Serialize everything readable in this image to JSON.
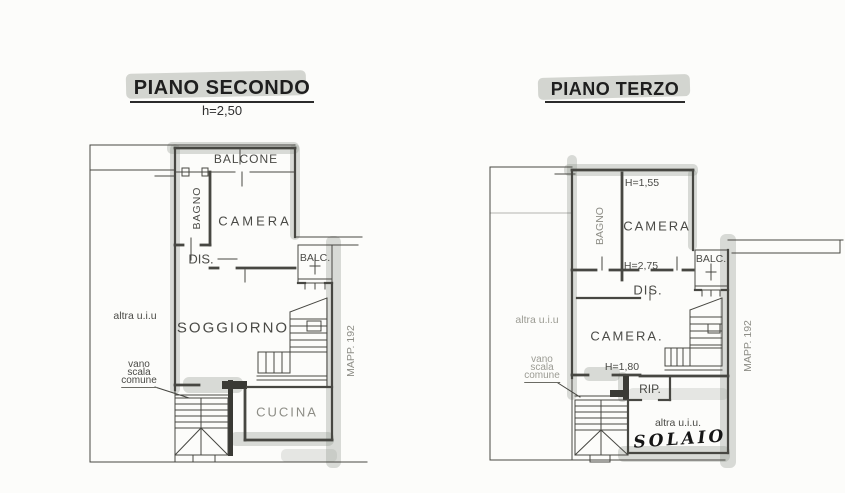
{
  "palette": {
    "paper": "#fcfcfa",
    "ink": "#474742",
    "marker_highlight": "#969c92"
  },
  "plans": {
    "secondo": {
      "title": "PIANO SECONDO",
      "height_note": "h=2,50",
      "rooms": {
        "balcone": "BALCONE",
        "bagno": "BAGNO",
        "camera": "CAMERA",
        "dis": "DIS.",
        "balc": "BALC.",
        "soggiorno": "SOGGIORNO",
        "cucina": "CUCINA"
      },
      "annotations": {
        "altra_uiu": "altra u.i.u",
        "vano": "vano",
        "scala": "scala",
        "comune": "comune",
        "mapp": "MAPP. 192"
      }
    },
    "terzo": {
      "title": "PIANO TERZO",
      "rooms": {
        "bagno": "BAGNO",
        "camera_top": "CAMERA",
        "dis": "DIS.",
        "balc": "BALC.",
        "camera_mid": "CAMERA.",
        "rip": "RIP."
      },
      "annotations": {
        "h155": "H=1,55",
        "h275": "H=2,75",
        "h180": "H=1,80",
        "altra_uiu_left": "altra u.i.u",
        "altra_uiu_bottom": "altra u.i.u.",
        "solaio": "SOLAIO",
        "vano": "vano",
        "scala": "scala",
        "comune": "comune",
        "mapp": "MAPP. 192"
      }
    }
  }
}
